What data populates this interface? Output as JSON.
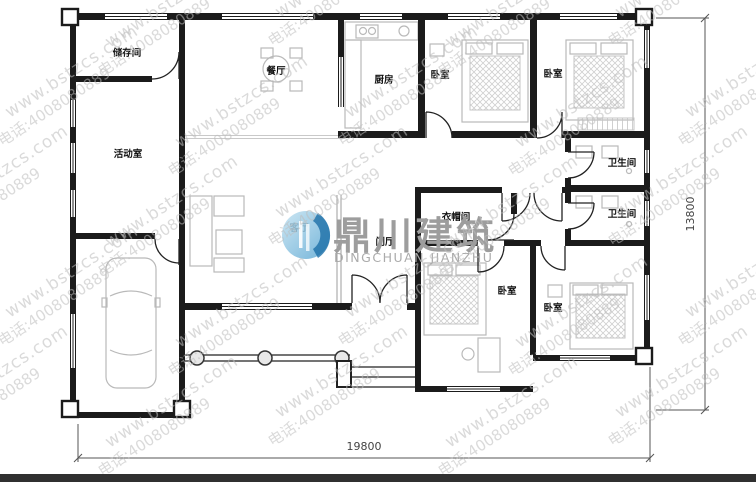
{
  "watermark": {
    "line1": "www.bstzcs.com",
    "line2": "电话:4008080889"
  },
  "logo": {
    "name_cn": "鼎川建筑",
    "name_en": "DINGCHUAN JIANZHU"
  },
  "dimensions": {
    "width_label": "19800",
    "height_label": "13800"
  },
  "rooms": [
    {
      "label": "储存间"
    },
    {
      "label": "餐厅"
    },
    {
      "label": "厨房"
    },
    {
      "label": "卧室"
    },
    {
      "label": "卧室"
    },
    {
      "label": "活动室"
    },
    {
      "label": "卫生间"
    },
    {
      "label": "卫生间"
    },
    {
      "label": "客厅"
    },
    {
      "label": "衣帽间"
    },
    {
      "label": "门厅"
    },
    {
      "label": "卧室"
    },
    {
      "label": "卧室"
    }
  ],
  "colors": {
    "wall": "#1b1b1b",
    "furniture": "#b9b9b9",
    "watermark": "#bdbdbd",
    "dim": "#444444",
    "footer_bar": "#303030",
    "logo_blue": "#2e7fb8"
  }
}
